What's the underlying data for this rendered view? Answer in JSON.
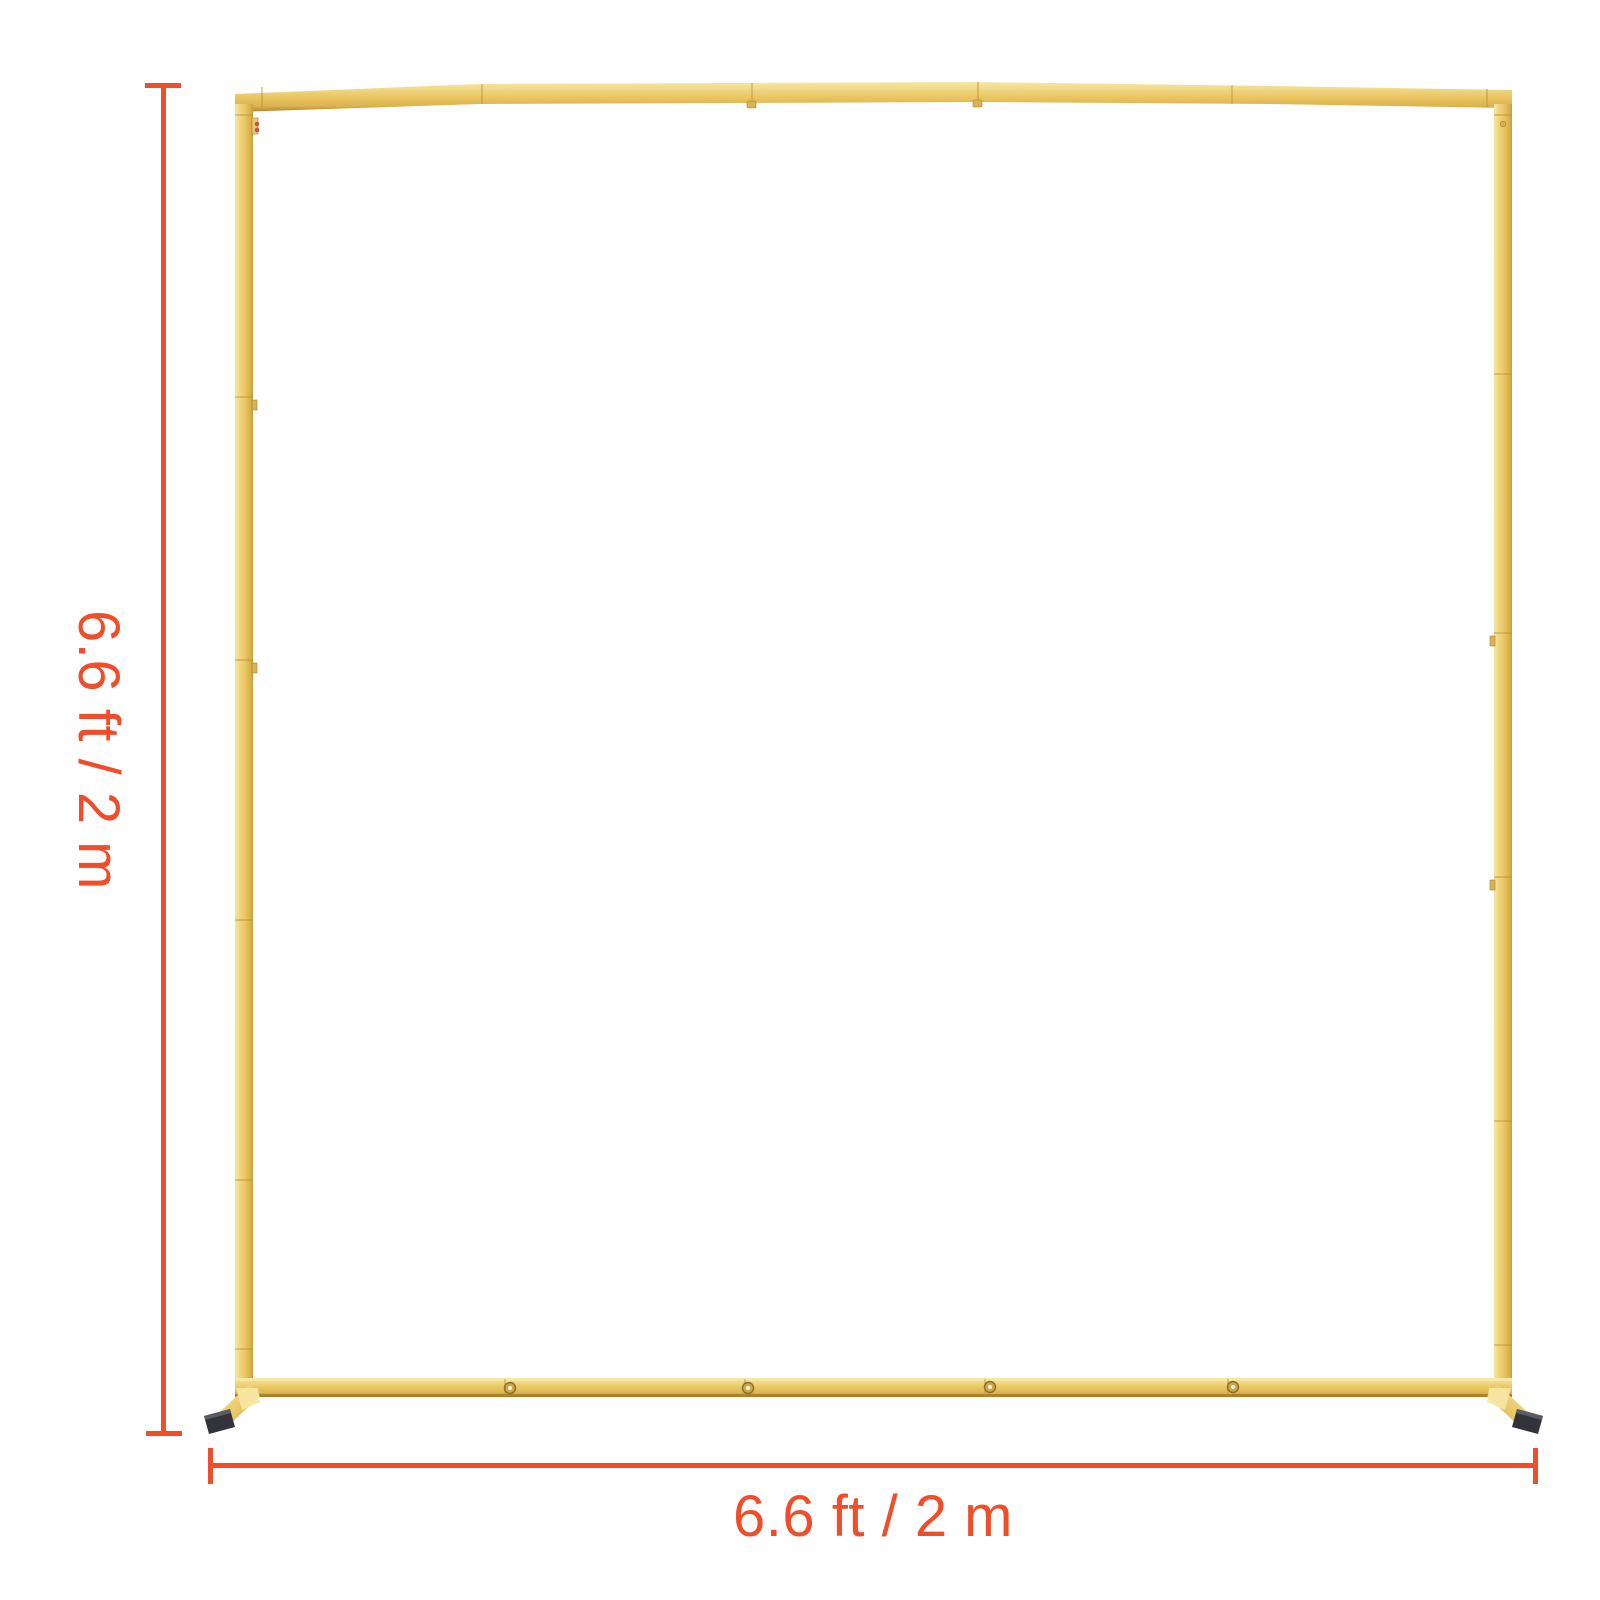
{
  "diagram": {
    "illustration": "gold-backdrop-stand-frame",
    "height_dimension": {
      "label": "6.6 ft / 2 m",
      "orientation": "vertical"
    },
    "width_dimension": {
      "label": "6.6 ft / 2 m",
      "orientation": "horizontal"
    },
    "colors": {
      "accent": "#F04E2B",
      "frame_gold": "#EAC662",
      "frame_gold_light": "#F7E7A6",
      "frame_gold_dark": "#C79B3C",
      "frame_gold_deep": "#A87F28",
      "foot_cap": "#33343B",
      "background": "#FFFFFF"
    }
  }
}
